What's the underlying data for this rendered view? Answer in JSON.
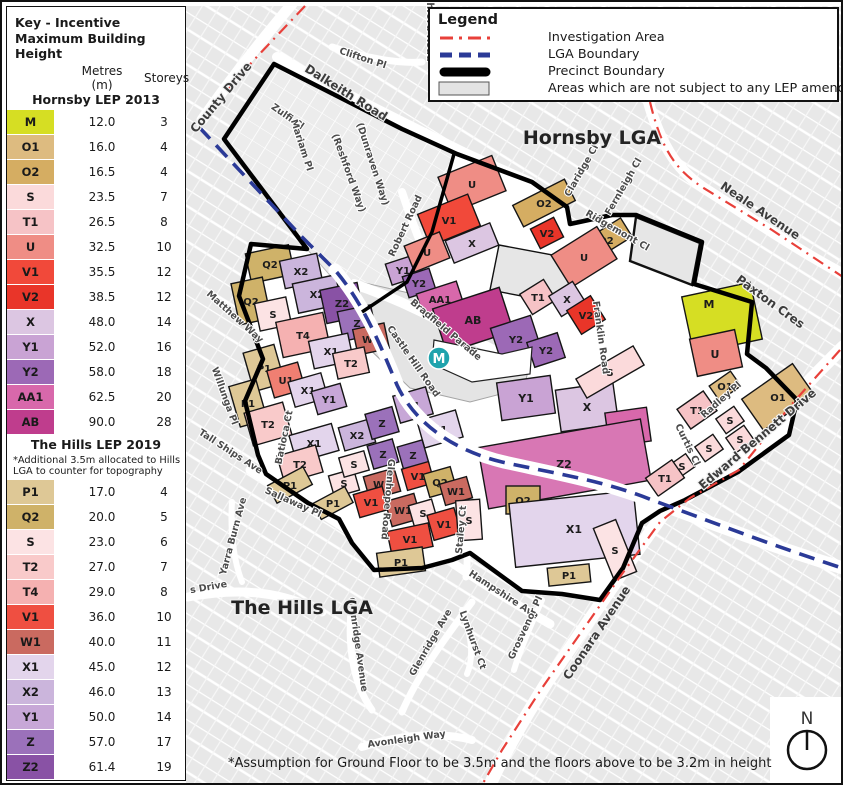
{
  "page": {
    "footnote": "*Assumption for Ground Floor to be 3.5m and the floors above to be 3.2m in height",
    "compass_label": "N"
  },
  "key": {
    "title": "Key - Incentive Maximum Building Height",
    "col_metres": "Metres (m)",
    "col_storeys": "Storeys",
    "hornsby": {
      "title": "Hornsby LEP 2013",
      "rows": [
        {
          "code": "M",
          "metres": "12.0",
          "storeys": "3",
          "color": "#d6de23"
        },
        {
          "code": "O1",
          "metres": "16.0",
          "storeys": "4",
          "color": "#ddbb80"
        },
        {
          "code": "O2",
          "metres": "16.5",
          "storeys": "4",
          "color": "#d5ad62"
        },
        {
          "code": "S",
          "metres": "23.5",
          "storeys": "7",
          "color": "#fbdadb"
        },
        {
          "code": "T1",
          "metres": "26.5",
          "storeys": "8",
          "color": "#f6c3c6"
        },
        {
          "code": "U",
          "metres": "32.5",
          "storeys": "10",
          "color": "#ef8d85"
        },
        {
          "code": "V1",
          "metres": "35.5",
          "storeys": "12",
          "color": "#f1493a"
        },
        {
          "code": "V2",
          "metres": "38.5",
          "storeys": "12",
          "color": "#e93529"
        },
        {
          "code": "X",
          "metres": "48.0",
          "storeys": "14",
          "color": "#dcc6e2"
        },
        {
          "code": "Y1",
          "metres": "52.0",
          "storeys": "16",
          "color": "#c9a3d4"
        },
        {
          "code": "Y2",
          "metres": "58.0",
          "storeys": "18",
          "color": "#9c69b6"
        },
        {
          "code": "AA1",
          "metres": "62.5",
          "storeys": "20",
          "color": "#d868ab"
        },
        {
          "code": "AB",
          "metres": "90.0",
          "storeys": "28",
          "color": "#bf3d8d"
        }
      ]
    },
    "hills": {
      "title": "The Hills LEP 2019",
      "note": "*Additional 3.5m allocated to Hills LGA to counter for topography",
      "rows": [
        {
          "code": "P1",
          "metres": "17.0",
          "storeys": "4",
          "color": "#dec896"
        },
        {
          "code": "Q2",
          "metres": "20.0",
          "storeys": "5",
          "color": "#cfb269"
        },
        {
          "code": "S",
          "metres": "23.0",
          "storeys": "6",
          "color": "#fce3e4"
        },
        {
          "code": "T2",
          "metres": "27.0",
          "storeys": "7",
          "color": "#f9caca"
        },
        {
          "code": "T4",
          "metres": "29.0",
          "storeys": "8",
          "color": "#f5b1b1"
        },
        {
          "code": "V1",
          "metres": "36.0",
          "storeys": "10",
          "color": "#ef4f41"
        },
        {
          "code": "W1",
          "metres": "40.0",
          "storeys": "11",
          "color": "#ca6a60"
        },
        {
          "code": "X1",
          "metres": "45.0",
          "storeys": "12",
          "color": "#e3d5ec"
        },
        {
          "code": "X2",
          "metres": "46.0",
          "storeys": "13",
          "color": "#cbb5dc"
        },
        {
          "code": "Y1",
          "metres": "50.0",
          "storeys": "14",
          "color": "#c7a7d7"
        },
        {
          "code": "Z",
          "metres": "57.0",
          "storeys": "17",
          "color": "#9b71ba"
        },
        {
          "code": "Z2",
          "metres": "61.4",
          "storeys": "19",
          "color": "#8952a5"
        }
      ]
    }
  },
  "legend": {
    "title": "Legend",
    "items": [
      {
        "name": "investigation-area",
        "label": "Investigation Area",
        "color": "#e8403a"
      },
      {
        "name": "lga-boundary",
        "label": "LGA Boundary",
        "color": "#2b3a97"
      },
      {
        "name": "precinct-boundary",
        "label": "Precinct Boundary",
        "color": "#000000"
      },
      {
        "name": "no-lep-amendment",
        "label": "Areas which are not subject to any LEP amendment",
        "color": "#e3e3e3"
      }
    ]
  },
  "palette": {
    "M": "#d6de23",
    "O1": "#ddbb80",
    "O2": "#d5ad62",
    "Sh": "#fbdadb",
    "T1": "#f6c3c6",
    "U": "#ef8d85",
    "V1h": "#f1493a",
    "V2": "#e93529",
    "X": "#dcc6e2",
    "Y1h": "#c9a3d4",
    "Y2": "#9c69b6",
    "AA1": "#d868ab",
    "AB": "#bf3d8d",
    "P1": "#dec896",
    "Q2": "#cfb269",
    "S": "#fce3e4",
    "T2": "#f9caca",
    "T4": "#f5b1b1",
    "V1": "#ef4f41",
    "W1": "#ca6a60",
    "X1": "#e3d5ec",
    "X2": "#cbb5dc",
    "Y1": "#c7a7d7",
    "Z": "#9b71ba",
    "Z2": "#8952a5",
    "Z2big": "#d877b4",
    "U1": "#f07f72",
    "grey": "#e3e3e3",
    "investigation": "#e8403a",
    "lga": "#2b3a97",
    "station": "#1fa3ad"
  },
  "map": {
    "area_labels": [
      "Hornsby LGA",
      "The Hills LGA"
    ],
    "station_label": "M",
    "streets": [
      "County Drive",
      "Clifton Pl",
      "Dalkeith Road",
      "hford Road",
      "Zulfi Cl",
      "Mariam Pl",
      "(Reshford Way)",
      "(Dunraven Way)",
      "Robert Road",
      "Claridge Cl",
      "Fernleigh Cl",
      "Ridgemont Cl",
      "Neale Avenue",
      "Paxton Cres",
      "Franklin Road",
      "Bradfield Parade",
      "Castle Hill Road",
      "Matthew Way",
      "Willunga Pl",
      "Tall Ships Ave",
      "Batioca Ct",
      "Sallaway Pl",
      "Yarra Burn Ave",
      "s Drive",
      "Glenhope Road",
      "Staley Ct",
      "Hampshire Ave",
      "Glenridge Ave",
      "Glenridge Avenue",
      "Lynhurst Ct",
      "Grosvenor Pl",
      "Coonara Avenue",
      "Avonleigh Way",
      "Edward Bennett Drive",
      "Curtis Cl",
      "Radley Pl"
    ],
    "zones": [
      "Q2",
      "X2",
      "X2",
      "Z2",
      "Z",
      "Q2",
      "S",
      "T4",
      "X1",
      "W1",
      "T2",
      "P1",
      "U1",
      "X1",
      "Y1",
      "P1",
      "T2",
      "X1",
      "T2",
      "X2",
      "Z",
      "Y1",
      "X1",
      "Z",
      "Z",
      "S",
      "S",
      "W1",
      "V1",
      "Q2",
      "W1",
      "V1",
      "W1",
      "S",
      "V1",
      "V1",
      "P1",
      "P1",
      "P1",
      "S",
      "Y1",
      "Y2",
      "AA1",
      "AB",
      "Y2",
      "Y2",
      "Y1",
      "X",
      "AA1",
      "Z2",
      "Q2",
      "X1",
      "P1",
      "S",
      "S",
      "U",
      "V1",
      "X",
      "U",
      "O2",
      "V2",
      "O2",
      "U",
      "T1",
      "X",
      "V2",
      "M",
      "U",
      "O1",
      "O1",
      "T1",
      "S",
      "S",
      "S",
      "S",
      "T1"
    ]
  }
}
